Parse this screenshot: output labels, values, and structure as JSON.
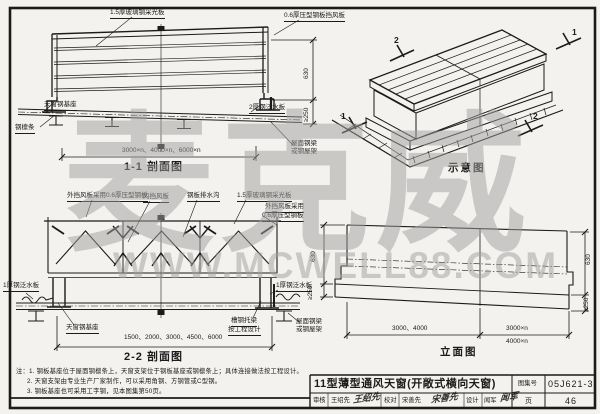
{
  "page": {
    "bg": "#f3f2ee",
    "ink": "#1b1b1b",
    "watermark_color": "#a0a0a0"
  },
  "watermark": {
    "brand": "麦克威",
    "site": "WWW.MCWELL88.COM"
  },
  "section11": {
    "label": "1-1 剖面图",
    "callout_top": "1.5厚玻璃钢采光板",
    "callout_right_top": "0.6厚压型钢板挡风板",
    "callout_base": "天窗钢基座",
    "callout_purlin": "钢檩条",
    "callout_flashing": "2厚钢泛水板",
    "callout_roof_line1": "屋面钢梁",
    "callout_roof_line2": "或钢屋架",
    "dim_span": "3000×n、4000×n、6000×n",
    "dim_h1": "630",
    "dim_h2": "≥250"
  },
  "iso": {
    "label": "示意图",
    "mark1": "1",
    "mark2": "2"
  },
  "section22": {
    "label": "2-2 剖面图",
    "callout_outer": "外挡风板采用0.6厚压型钢板",
    "callout_inner": "内挡风板",
    "callout_gutter": "钢板排水沟",
    "callout_frp": "1.5厚玻璃钢采光板",
    "callout_outer2a": "外挡风板采用",
    "callout_outer2b": "0.6厚压型钢板",
    "callout_flash_left": "1厚钢泛水板",
    "callout_flash_right": "1厚钢泛水板",
    "callout_base": "天窗钢基座",
    "callout_joist1": "槽钢托梁",
    "callout_joist2": "按工程设计",
    "callout_beam1": "屋面钢梁",
    "callout_beam2": "或钢屋架",
    "dim_span": "1500、2000、3000、4500、6000"
  },
  "elevation": {
    "label": "立面图",
    "dim_left_h1": "630",
    "dim_left_h2": "≥250",
    "dim_right_h1": "630",
    "dim_right_h2": "≥250",
    "dim_b1": "3000、4000",
    "dim_b2": "3000×n",
    "dim_b3": "4000×n"
  },
  "notes": {
    "line1": "注：1. 钢板基座位于屋面钢檩条上，天窗支架位于钢板基座或钢檩条上；具体连接做法按工程设计。",
    "line2": "2. 天窗支架由专业生产厂家制作，可以采用角钢、方钢管或C型钢。",
    "line3": "3. 钢板基座也可采用工字钢，见本图集第50页。"
  },
  "title_block": {
    "title": "11型薄型通风天窗(开敞式横向天窗)",
    "atlas_label": "图集号",
    "atlas_no": "05J621-3",
    "page_label": "页",
    "page_no": "46",
    "review_label": "审核",
    "review_name": "王绍先",
    "review_sig": "王绍先",
    "check_label": "校对",
    "check_name": "宋善先",
    "check_sig": "宋善先",
    "design_label": "设计",
    "design_name": "闻军",
    "design_sig": "闻军"
  }
}
